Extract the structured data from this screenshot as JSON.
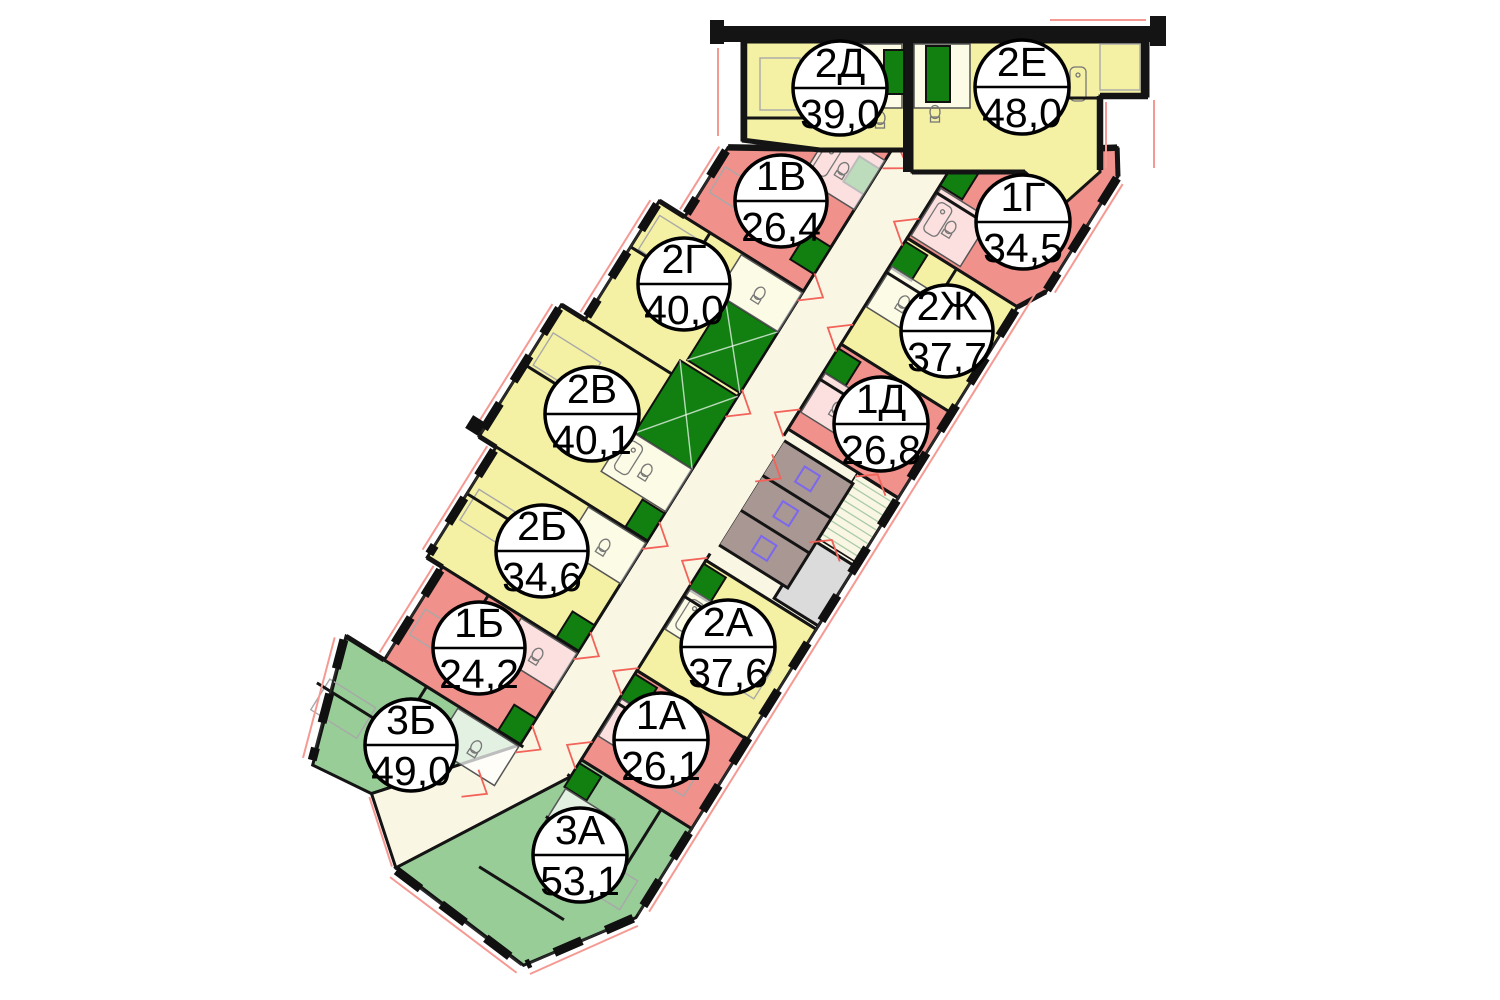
{
  "floorplan": {
    "apartments": [
      {
        "id": "2d",
        "label": "2Д",
        "area": "39,0",
        "color": "#F5F1A4"
      },
      {
        "id": "2e",
        "label": "2Е",
        "area": "48,0",
        "color": "#F5F1A4"
      },
      {
        "id": "1v",
        "label": "1В",
        "area": "26,4",
        "color": "#F0918C"
      },
      {
        "id": "1g",
        "label": "1Г",
        "area": "34,5",
        "color": "#F0918C"
      },
      {
        "id": "2g",
        "label": "2Г",
        "area": "40,0",
        "color": "#F5F1A4"
      },
      {
        "id": "2zh",
        "label": "2Ж",
        "area": "37,7",
        "color": "#F5F1A4"
      },
      {
        "id": "2v",
        "label": "2В",
        "area": "40,1",
        "color": "#F5F1A4"
      },
      {
        "id": "1d",
        "label": "1Д",
        "area": "26,8",
        "color": "#F0918C"
      },
      {
        "id": "2b",
        "label": "2Б",
        "area": "34,6",
        "color": "#F5F1A4"
      },
      {
        "id": "1b",
        "label": "1Б",
        "area": "24,2",
        "color": "#F0918C"
      },
      {
        "id": "2a",
        "label": "2А",
        "area": "37,6",
        "color": "#F5F1A4"
      },
      {
        "id": "1a",
        "label": "1А",
        "area": "26,1",
        "color": "#F0918C"
      },
      {
        "id": "3b",
        "label": "3Б",
        "area": "49,0",
        "color": "#98CD98"
      },
      {
        "id": "3a",
        "label": "3А",
        "area": "53,1",
        "color": "#98CD98"
      }
    ],
    "palette": {
      "one_room": "#F0918C",
      "two_room": "#F5F1A4",
      "three_room": "#98CD98",
      "corridor": "#FAF6E4",
      "elevator_shaft": "#A89793",
      "vestibule_gray": "#DBDBDB",
      "utility_shaft_green": "#118011",
      "wall": "#141414",
      "door_mark_red": "#F2635A",
      "balcony_line_red": "#F59A93"
    }
  }
}
